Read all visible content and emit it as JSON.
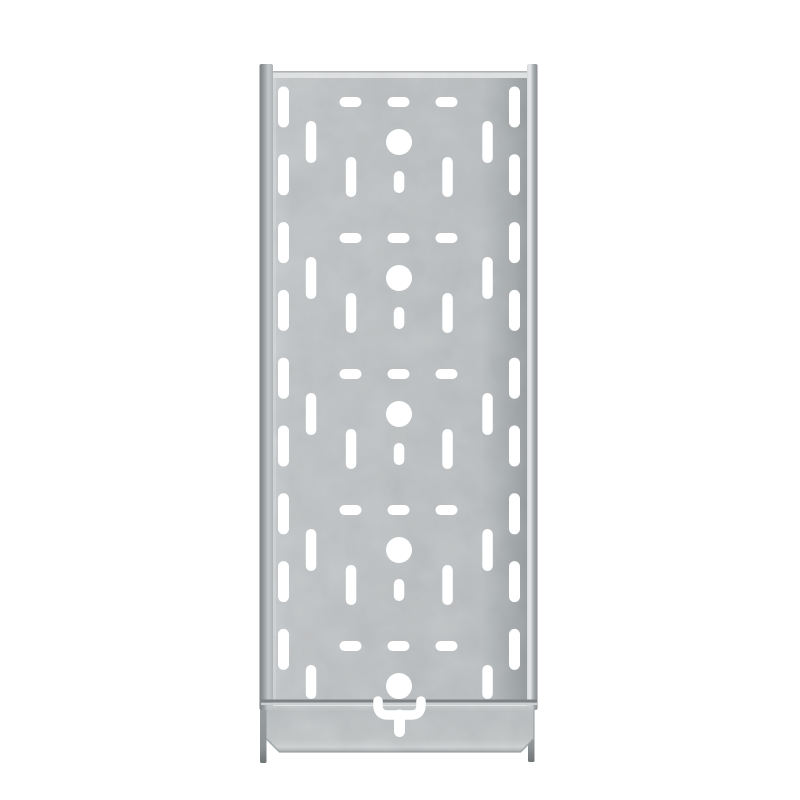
{
  "meta": {
    "description": "Product photo, front view: silver galvanized steel perforated cable tray section with raised side rails, rows of slotted ventilation perforations, five round fixing holes down the centre line, and a U-shaped coupling cut-out on the bottom connector plate, on a plain white background.",
    "canvas": {
      "width": 800,
      "height": 800
    }
  },
  "colors": {
    "background": "#ffffff",
    "hole": "#ffffff",
    "face_g0": "#cdd1d3",
    "face_g1": "#c7cbcd",
    "face_g2": "#c2c6c8",
    "face_g3": "#a8adaf",
    "face_g4": "#9da2a5",
    "face_left_highlight": "#dadcde",
    "top_edge_line": "#b0b4b6",
    "top_highlight": "#e9ebec",
    "rail_left_outer": "#7b8083",
    "rail_left_mid": "#989da0",
    "rail_left_inner": "#c4c8ca",
    "rail_left_edge": "#aeb3b5",
    "rail_right_inner": "#d5d8d9",
    "rail_right_highlight": "#e7e9ea",
    "rail_right_mid": "#a9aeb1",
    "rail_right_outer": "#878c8f",
    "seam_dark": "#7e8285",
    "seam_light": "#ccd0d1",
    "plate_g0": "#d0d4d5",
    "plate_g1": "#c3c7c9",
    "plate_g2": "#c8cccd",
    "plate_g3": "#d7dadb",
    "plate_g4": "#acb1b3",
    "plate_edge": "#9aa0a2",
    "foot_top": "#9a9fa2",
    "foot_mid": "#8d9295",
    "foot_tip": "#6f7476",
    "grain_dark": "#000000",
    "grain_light": "#ffffff"
  },
  "tray": {
    "perforations": {
      "module_rows_y": [
        142,
        278,
        414,
        550,
        686
      ],
      "circle": {
        "x": 399,
        "r": 13
      },
      "dash_row": {
        "dy": -40,
        "xs": [
          350.5,
          398.5,
          446.5
        ],
        "w": 22,
        "h": 10
      },
      "inner_slots": {
        "xs": [
          311,
          487.5
        ],
        "w": 10.5,
        "h": 42,
        "last_row_h": 34,
        "last_row_dy": -4
      },
      "mid_slots": {
        "xs": [
          351,
          447.5
        ],
        "w": 10.5,
        "h": 40,
        "dy": 35,
        "rows": 4
      },
      "tail_slot": {
        "x": 399,
        "w": 10.5,
        "h": 22,
        "dy": 40,
        "rows": 4
      },
      "edge_columns": {
        "xs": [
          283.5,
          514.5
        ],
        "w": 11,
        "h": 41,
        "ys": [
          107,
          174.8,
          242.6,
          310.4,
          378.2,
          446,
          513.8,
          581.6,
          649.4
        ]
      }
    },
    "coupling": {
      "bracket_path": "M 378 701 L 378 705 Q 378 715 388 715 L 411 715 Q 421 715 421 705 L 421 701",
      "bracket_stroke_w": 9.5,
      "tail": {
        "x": 399.5,
        "y1": 715,
        "y2": 731.5,
        "stroke_w": 11
      }
    }
  }
}
